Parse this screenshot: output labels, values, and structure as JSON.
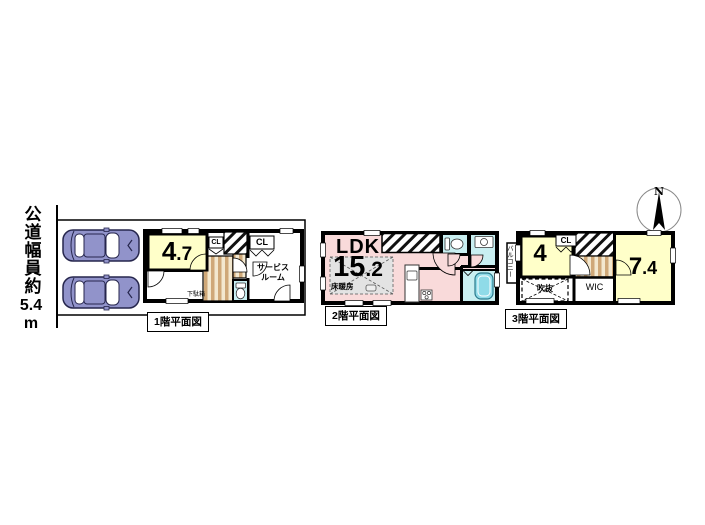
{
  "road": {
    "kanji": "公道幅員約",
    "number": "5.4",
    "unit": "m"
  },
  "compass": {
    "north": "N"
  },
  "floor1": {
    "title": "1階平面図",
    "room_size_main": "4",
    "room_size_dec": ".7",
    "closet_small": "CL",
    "closet_large": "CL",
    "service_room_line1": "サービス",
    "service_room_line2": "ルーム",
    "shoe_cabinet": "下駄箱"
  },
  "floor2": {
    "title": "2階平面図",
    "ldk_label": "LDK",
    "ldk_size_main": "15",
    "ldk_size_dec": ".2",
    "floor_heating": "床暖房"
  },
  "floor3": {
    "title": "3階平面図",
    "balcony": "バルコニー",
    "room_left_size": "4",
    "closet": "CL",
    "void_label": "吹抜",
    "wic_label": "WIC",
    "room_right_main": "7",
    "room_right_dec": ".4"
  },
  "colors": {
    "room_yellow": "#ffffc9",
    "ldk_pink": "#f9dada",
    "wet_cyan": "#c9eff1",
    "bathtub_cyan": "#8fdbe8",
    "stair_tan": "#cfa878",
    "stair_cream": "#f3e8cf",
    "car_body": "#9193ca",
    "heating_grey": "#e3e3e3"
  }
}
